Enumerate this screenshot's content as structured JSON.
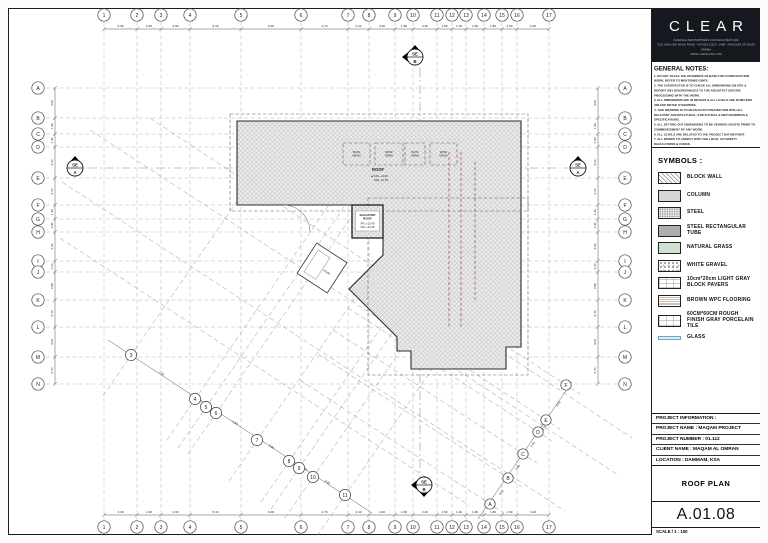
{
  "sheet_header": {
    "logo": "CLEAR",
    "line1": "ALMASAH AND PARTNERS FOR ARCHITECTURE",
    "line2": "7522 ANAS IBN MALIK ROAD - RIYADH 13524 - 2488 - KINGDOM OF SAUDI ARABIA",
    "line3": "WWW.CLEAR-KSA.COM"
  },
  "general_notes": {
    "title": "GENERAL NOTES:",
    "notes": [
      "1. DO NOT SCALE THE DRAWINGS AS BASE FOR CONSTRUCTION WORK, REFER TO MENTIONED DIM'S.",
      "2. THE CONTRACTOR IS TO CHECK ALL DIMENSIONS ON SITE & REPORT ANY DISCREPANCIES TO THE ARCHITECT BEFORE PROCEEDING WITH THE WORK.",
      "3. ALL DIMENSIONS ARE IN METERS & ALL LEVELS ARE IN METERS UNLESS NOTED OTHERWISE.",
      "4. THIS DRAWING IS TO BE READ IN CONJUNCTION WITH ALL RELEVANT ARCHITECTURAL, STRUCTURAL & MEP DRAWINGS & SPECIFICATIONS.",
      "5. ALL SETTING OUT DIMENSIONS TO BE VERIFIED ON SITE PRIOR TO COMMENCEMENT OF ANY WORK.",
      "6. ALL LEVELS ARE RELATED TO THE PROJECT DATUM POINT.",
      "7. ALL WORKS TO COMPLY WITH THE LOCAL AUTHORITY REGULATIONS & CODES.",
      "8. FOR WINDOWS & DOORS DETAILS REFER TO DOORS & WINDOWS SCHEDULE DWG'S.",
      "9. ANY DISCREPANCY TO BE REPORTED IMMEDIATELY TO THE ARCHITECT."
    ]
  },
  "symbols": {
    "title": "SYMBOLS :",
    "items": [
      {
        "key": "block-wall",
        "label": "BLOCK WALL"
      },
      {
        "key": "column",
        "label": "COLUMN"
      },
      {
        "key": "steel",
        "label": "STEEL"
      },
      {
        "key": "steel-tube",
        "label": "STEEL RECTANGULAR TUBE"
      },
      {
        "key": "natural-grass",
        "label": "NATURAL GRASS"
      },
      {
        "key": "white-gravel",
        "label": "WHITE GRAVEL"
      },
      {
        "key": "block-pavers",
        "label": "10cm*20cm LIGHT GRAY BLOCK PAVERS"
      },
      {
        "key": "wpc-flooring",
        "label": "BROWN WPC FLOORING"
      },
      {
        "key": "porcelain-tile",
        "label": "60CM*60CM ROUGH FINISH GRAY PORCELAIN TILE"
      },
      {
        "key": "glass",
        "label": "GLASS"
      }
    ]
  },
  "project_info": {
    "rows": [
      "PROJECT INFORMATION :",
      "PROJECT NAME : MAQAM PROJECT",
      "PROJECT NUMBER : 01.112",
      "CLIENT NAME : MAQAM AL OMRAN",
      "LOCATION : DAMMAM, KSA"
    ]
  },
  "title_block": {
    "drawing_title": "ROOF PLAN",
    "sheet_number": "A.01.08",
    "scale": "SCALE / 1 : 100"
  },
  "plan": {
    "level_symbol": "▲",
    "roof_label": {
      "name": "ROOF",
      "ffl": "FFL +9.90",
      "ssl": "SSL +9.75"
    },
    "elevator_label": {
      "l1": "ELEVATOR",
      "l2": "ROOF",
      "ffl": "FFL +13.40",
      "ssl": "SSL +13.25"
    },
    "stair_label": "STAIR",
    "cols": [
      {
        "label": "1",
        "x": 104
      },
      {
        "label": "2",
        "x": 137
      },
      {
        "label": "3",
        "x": 161
      },
      {
        "label": "4",
        "x": 190
      },
      {
        "label": "5",
        "x": 241
      },
      {
        "label": "6",
        "x": 301
      },
      {
        "label": "7",
        "x": 348
      },
      {
        "label": "8",
        "x": 369
      },
      {
        "label": "9",
        "x": 395
      },
      {
        "label": "10",
        "x": 413
      },
      {
        "label": "11",
        "x": 437
      },
      {
        "label": "12",
        "x": 452
      },
      {
        "label": "13",
        "x": 466
      },
      {
        "label": "14",
        "x": 484
      },
      {
        "label": "15",
        "x": 502
      },
      {
        "label": "16",
        "x": 517
      },
      {
        "label": "17",
        "x": 549
      }
    ],
    "rows": [
      {
        "label": "A",
        "y": 88
      },
      {
        "label": "B",
        "y": 118
      },
      {
        "label": "C",
        "y": 134
      },
      {
        "label": "D",
        "y": 147
      },
      {
        "label": "E",
        "y": 178
      },
      {
        "label": "F",
        "y": 205
      },
      {
        "label": "G",
        "y": 219
      },
      {
        "label": "H",
        "y": 232
      },
      {
        "label": "I",
        "y": 261
      },
      {
        "label": "J",
        "y": 272
      },
      {
        "label": "K",
        "y": 300
      },
      {
        "label": "L",
        "y": 327
      },
      {
        "label": "M",
        "y": 357
      },
      {
        "label": "N",
        "y": 384
      }
    ],
    "top_dims": [
      "3.30",
      "2.40",
      "2.90",
      "5.10",
      "6.00",
      "4.70",
      "2.10",
      "4.40",
      "1.80",
      "2.40",
      "1.50",
      "1.40",
      "1.80",
      "1.80",
      "1.50",
      "3.20"
    ],
    "bottom_dims": [
      "3.30",
      "2.40",
      "2.90",
      "5.10",
      "6.00",
      "4.70",
      "2.10",
      "4.40",
      "1.80",
      "2.40",
      "1.50",
      "1.40",
      "1.80",
      "1.80",
      "1.50",
      "3.20"
    ],
    "left_dims": [
      "3.00",
      "1.60",
      "1.30",
      "3.10",
      "2.70",
      "1.40",
      "1.30",
      "2.90",
      "1.10",
      "2.80",
      "2.70",
      "3.00",
      "2.70"
    ],
    "right_dims": [
      "3.00",
      "1.60",
      "1.30",
      "3.10",
      "2.70",
      "1.40",
      "1.30",
      "2.90",
      "1.10",
      "2.80",
      "2.70",
      "3.00",
      "2.70"
    ],
    "diag_bubbles": [
      {
        "label": "3",
        "x": 131,
        "y": 355
      },
      {
        "label": "4",
        "x": 195,
        "y": 399
      },
      {
        "label": "5",
        "x": 206,
        "y": 407
      },
      {
        "label": "6",
        "x": 216,
        "y": 413
      },
      {
        "label": "7",
        "x": 257,
        "y": 440
      },
      {
        "label": "8",
        "x": 289,
        "y": 461
      },
      {
        "label": "9",
        "x": 299,
        "y": 468
      },
      {
        "label": "10",
        "x": 313,
        "y": 477
      },
      {
        "label": "11",
        "x": 345,
        "y": 495
      }
    ],
    "diag_dims": [
      "7.70",
      "1.30",
      "1.20",
      "4.90",
      "3.90",
      "1.20",
      "1.70",
      "3.60"
    ],
    "diag_letter_bubbles": [
      {
        "label": "A",
        "x": 490,
        "y": 504
      },
      {
        "label": "B",
        "x": 508,
        "y": 478
      },
      {
        "label": "C",
        "x": 523,
        "y": 454
      },
      {
        "label": "D",
        "x": 538,
        "y": 432
      },
      {
        "label": "E",
        "x": 546,
        "y": 420
      },
      {
        "label": "F",
        "x": 566,
        "y": 385
      }
    ],
    "letter_dims": [
      "3.10",
      "2.80",
      "2.40",
      "1.50",
      "4.00"
    ],
    "roof_boxes": [
      {
        "x": 343,
        "y": 143,
        "w": 27,
        "h": 22,
        "l1": "ROOF",
        "l2": "DRAIN"
      },
      {
        "x": 375,
        "y": 143,
        "w": 28,
        "h": 22,
        "l1": "ROOF",
        "l2": "DRAIN"
      },
      {
        "x": 405,
        "y": 143,
        "w": 20,
        "h": 22,
        "l1": "ROOF",
        "l2": "DRAIN"
      },
      {
        "x": 430,
        "y": 143,
        "w": 27,
        "h": 22,
        "l1": "ROOF",
        "l2": "DRAIN"
      }
    ],
    "sections": [
      {
        "x": 75,
        "y": 168,
        "top": "SE",
        "bottom": "A",
        "tris": [
          "top"
        ]
      },
      {
        "x": 578,
        "y": 168,
        "top": "SE",
        "bottom": "A",
        "tris": [
          "top"
        ]
      },
      {
        "x": 415,
        "y": 57,
        "top": "SE",
        "bottom": "B",
        "tris": [
          "left",
          "top"
        ]
      },
      {
        "x": 424,
        "y": 485,
        "top": "SE",
        "bottom": "B",
        "tris": [
          "left",
          "bottom"
        ]
      }
    ],
    "extra_diagonals": [
      [
        60,
        238,
        470,
        506
      ],
      [
        62,
        182,
        565,
        511
      ],
      [
        90,
        130,
        618,
        475
      ],
      [
        150,
        118,
        632,
        438
      ]
    ],
    "red_lines": [
      [
        449,
        152,
        449,
        328
      ],
      [
        461,
        152,
        461,
        328
      ],
      [
        475,
        162,
        475,
        300
      ]
    ]
  }
}
